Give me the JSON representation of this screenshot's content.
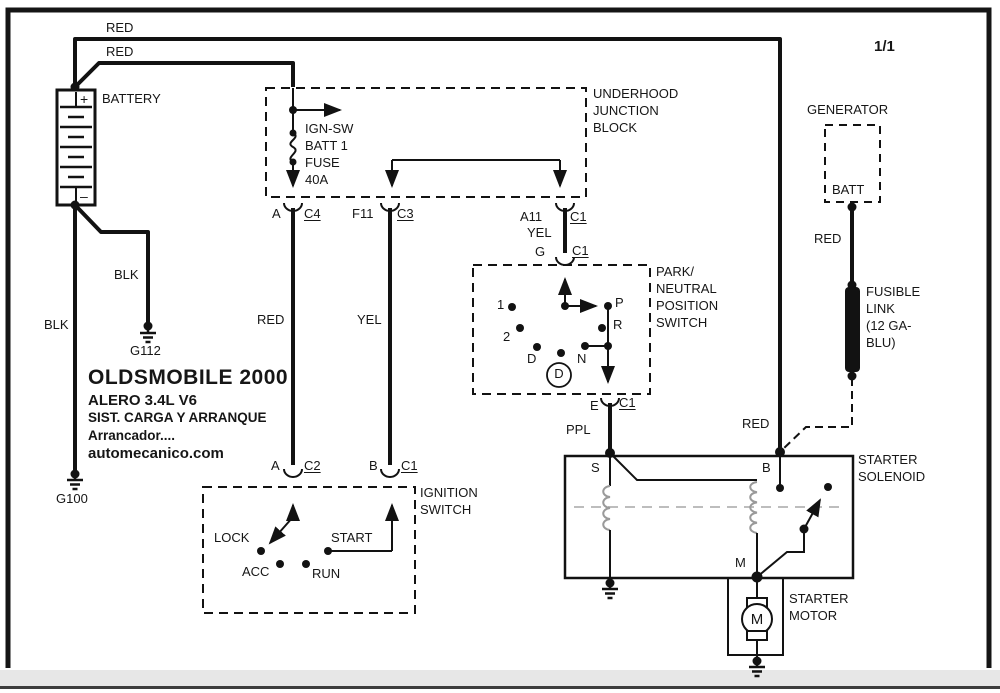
{
  "page_number": "1/1",
  "title_block": {
    "line1": "OLDSMOBILE 2000",
    "line2": "ALERO  3.4L  V6",
    "line3": "SIST. CARGA Y ARRANQUE",
    "line4": "Arrancador....",
    "line5": "automecanico.com"
  },
  "battery": {
    "name": "BATTERY",
    "plus": "+",
    "minus": "–"
  },
  "wires": {
    "red_top": "RED",
    "red_mid": "RED",
    "blk_left": "BLK",
    "blk_right": "BLK",
    "red_ignition_feed": "RED",
    "yel_ignition_feed": "YEL",
    "yel_pnp_feed": "YEL",
    "ppl_solenoid_feed": "PPL",
    "red_generator": "RED",
    "red_solenoid": "RED"
  },
  "grounds": {
    "g100": "G100",
    "g112": "G112"
  },
  "junction_block": {
    "title": "UNDERHOOD\nJUNCTION\nBLOCK",
    "fuse_label": "IGN-SW\nBATT 1\nFUSE\n40A",
    "conn_a": "A",
    "conn_c4": "C4",
    "conn_f11": "F11",
    "conn_c3": "C3",
    "conn_a11": "A11",
    "conn_a11_c1": "C1"
  },
  "pnp_switch": {
    "title": "PARK/\nNEUTRAL\nPOSITION\nSWITCH",
    "conn_g": "G",
    "conn_g_c1": "C1",
    "conn_e": "E",
    "conn_e_c1": "C1",
    "pos_1": "1",
    "pos_2": "2",
    "pos_d": "D",
    "pos_n": "N",
    "pos_r": "R",
    "pos_p": "P",
    "indicator_d": "D"
  },
  "ignition_switch": {
    "title": "IGNITION\nSWITCH",
    "conn_a": "A",
    "conn_c2": "C2",
    "conn_b": "B",
    "conn_c1": "C1",
    "pos_lock": "LOCK",
    "pos_acc": "ACC",
    "pos_run": "RUN",
    "pos_start": "START"
  },
  "generator": {
    "title": "GENERATOR",
    "terminal": "BATT"
  },
  "fusible_link": {
    "label": "FUSIBLE\nLINK\n(12 GA-\nBLU)"
  },
  "starter_solenoid": {
    "title": "STARTER\nSOLENOID",
    "term_s": "S",
    "term_b": "B",
    "term_m": "M"
  },
  "starter_motor": {
    "title": "STARTER\nMOTOR",
    "symbol": "M"
  },
  "colors": {
    "wire": "#121212",
    "coil_gray": "#9a9a9a",
    "plunger_dash_gray": "#bdbdbd",
    "footer_bar_gray": "#e7e7e7"
  }
}
